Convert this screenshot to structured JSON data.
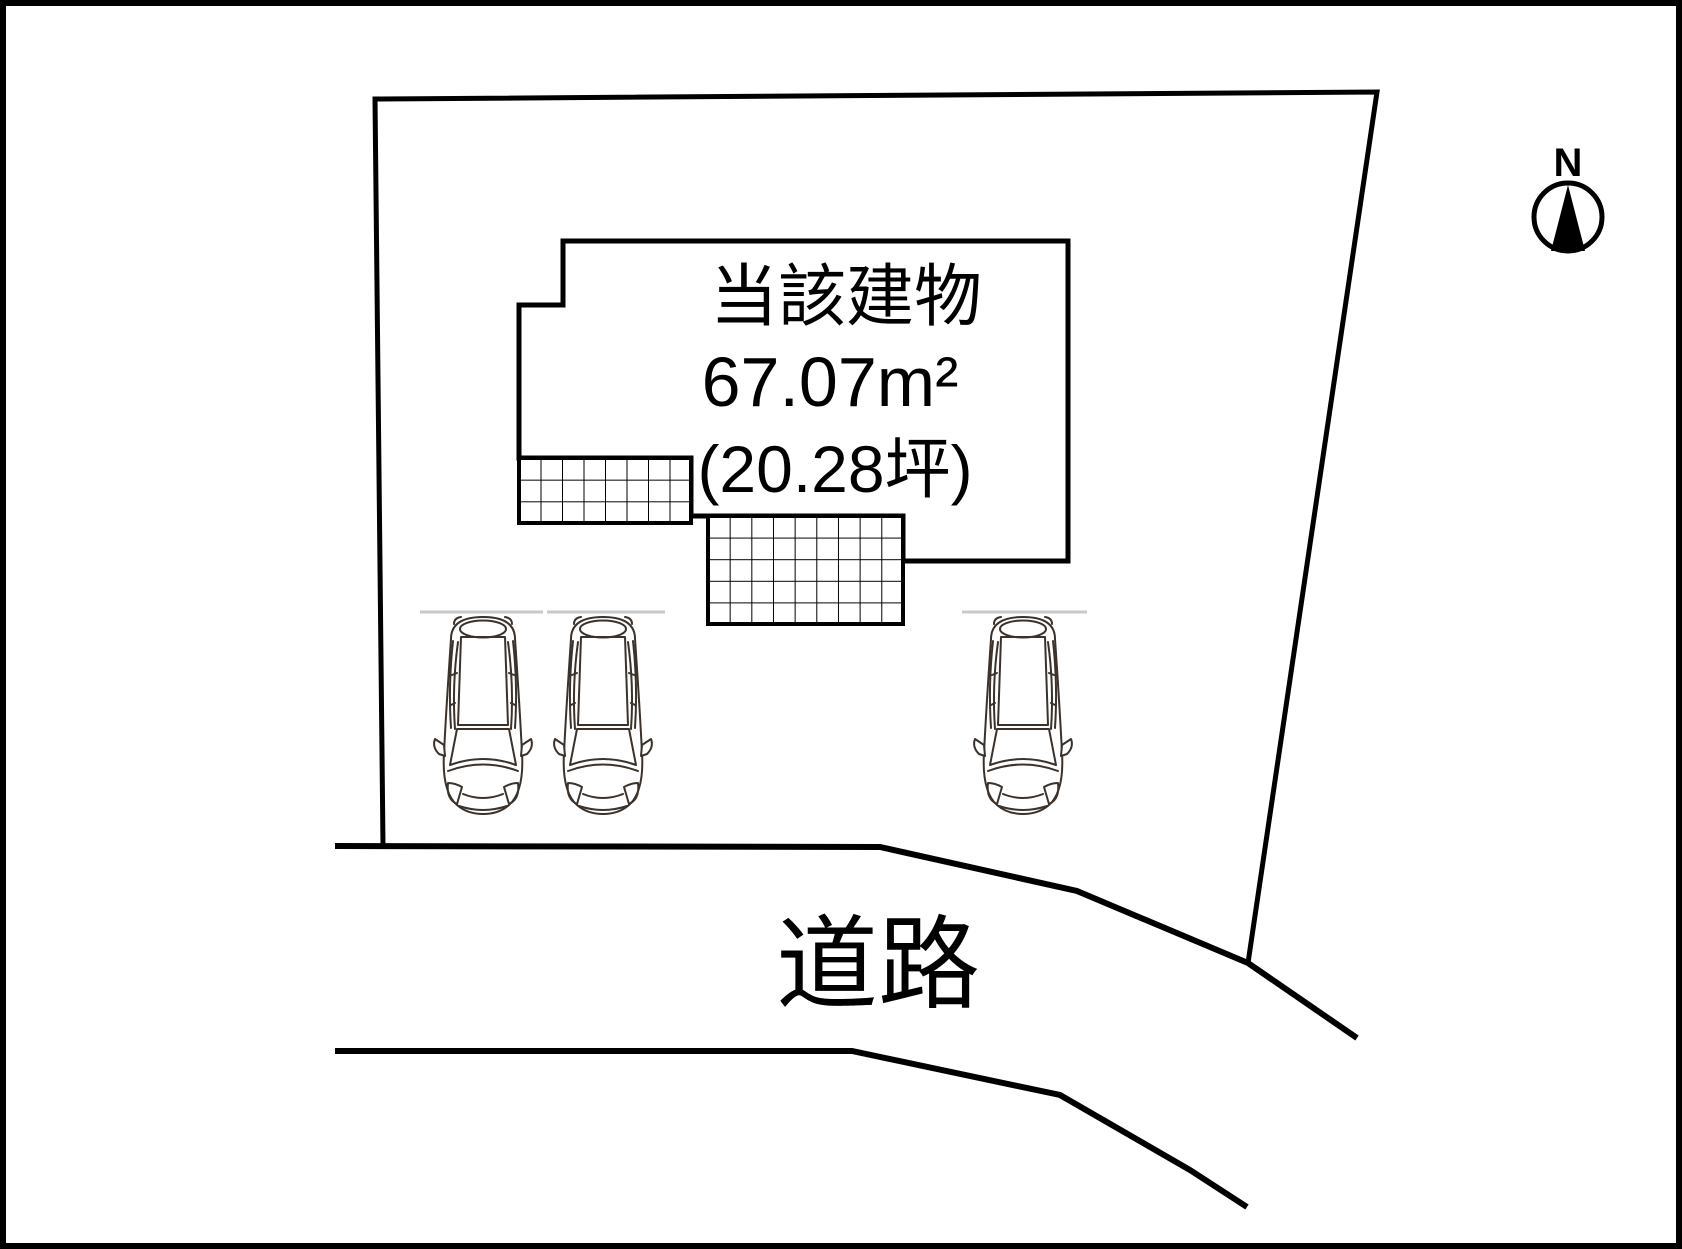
{
  "site_plan": {
    "building": {
      "label": "当該建物",
      "area_m2": "67.07m²",
      "area_tsubo": "(20.28坪)"
    },
    "road": {
      "label": "道路"
    },
    "compass": {
      "label": "N"
    },
    "parking": {
      "car_count": 3
    }
  },
  "colors": {
    "line": "#000000",
    "car_line": "#3a322b",
    "parking_line": "#c9c9c9",
    "background": "#ffffff"
  }
}
